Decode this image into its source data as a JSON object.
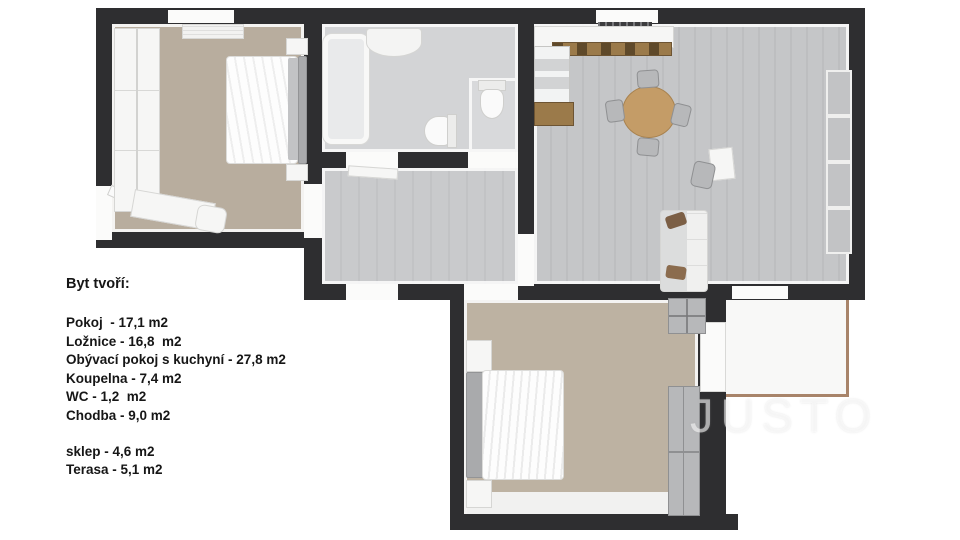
{
  "legend": {
    "title": "Byt tvoří:",
    "rooms": [
      "Pokoj  - 17,1 m2",
      "Ložnice - 16,8  m2",
      "Obývací pokoj s kuchyní - 27,8 m2",
      "Koupelna - 7,4 m2",
      "WC - 1,2  m2",
      "Chodba - 9,0 m2"
    ],
    "extras": [
      "sklep - 4,6 m2",
      "Terasa - 5,1 m2"
    ]
  },
  "watermark": "JUSTO",
  "rooms": [
    {
      "name": "Pokoj",
      "area": "17,1 m2"
    },
    {
      "name": "Ložnice",
      "area": "16,8 m2"
    },
    {
      "name": "Obývací pokoj s kuchyní",
      "area": "27,8 m2"
    },
    {
      "name": "Koupelna",
      "area": "7,4 m2"
    },
    {
      "name": "WC",
      "area": "1,2 m2"
    },
    {
      "name": "Chodba",
      "area": "9,0 m2"
    },
    {
      "name": "sklep",
      "area": "4,6 m2"
    },
    {
      "name": "Terasa",
      "area": "5,1 m2"
    }
  ],
  "colors": {
    "wall": "#2e2e30",
    "floor-beige": "#b8ad9e",
    "floor-beige2": "#bdb2a2",
    "floor-gray": "#d3d4d6",
    "floor-hall": "#c9cacc",
    "floor-living": "#c5c6c8",
    "wood": "#9b7a4a",
    "table-wood": "#c49c67",
    "terrace-edge": "#a8846a",
    "watermark": "rgba(255,255,255,0.55)"
  }
}
